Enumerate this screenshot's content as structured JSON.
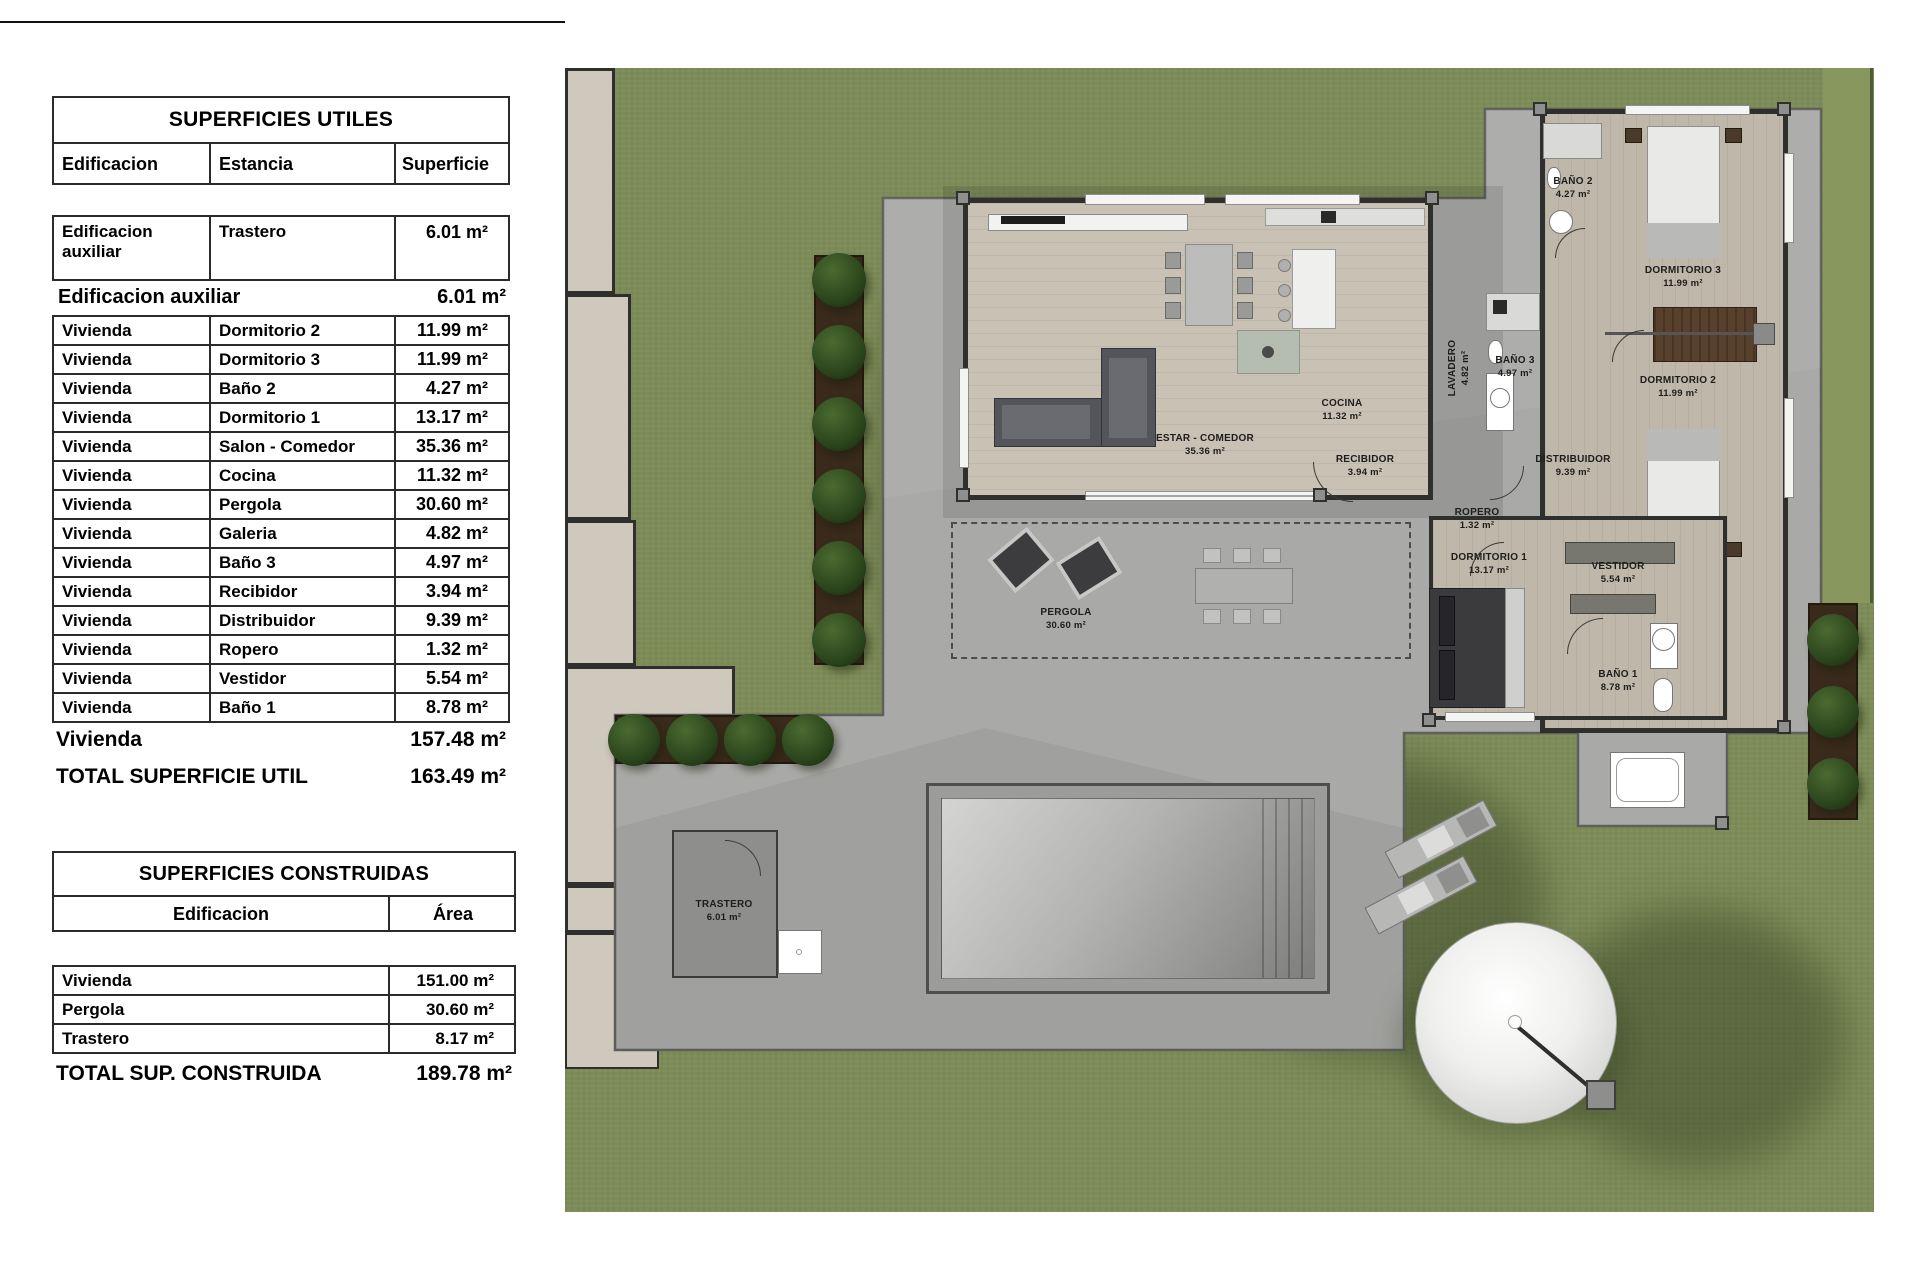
{
  "tables": {
    "utiles": {
      "title": "SUPERFICIES UTILES",
      "columns": {
        "c1": "Edificacion",
        "c2": "Estancia",
        "c3": "Superficie"
      },
      "aux_row": {
        "edificacion": "Edificacion auxiliar",
        "estancia": "Trastero",
        "superficie": "6.01 m²"
      },
      "aux_total": {
        "label": "Edificacion auxiliar",
        "value": "6.01 m²"
      },
      "rows": [
        {
          "edificacion": "Vivienda",
          "estancia": "Dormitorio 2",
          "superficie": "11.99 m²"
        },
        {
          "edificacion": "Vivienda",
          "estancia": "Dormitorio 3",
          "superficie": "11.99 m²"
        },
        {
          "edificacion": "Vivienda",
          "estancia": "Baño 2",
          "superficie": "4.27 m²"
        },
        {
          "edificacion": "Vivienda",
          "estancia": "Dormitorio 1",
          "superficie": "13.17 m²"
        },
        {
          "edificacion": "Vivienda",
          "estancia": "Salon  - Comedor",
          "superficie": "35.36 m²"
        },
        {
          "edificacion": "Vivienda",
          "estancia": "Cocina",
          "superficie": "11.32 m²"
        },
        {
          "edificacion": "Vivienda",
          "estancia": "Pergola",
          "superficie": "30.60 m²"
        },
        {
          "edificacion": "Vivienda",
          "estancia": "Galeria",
          "superficie": "4.82 m²"
        },
        {
          "edificacion": "Vivienda",
          "estancia": "Baño 3",
          "superficie": "4.97 m²"
        },
        {
          "edificacion": "Vivienda",
          "estancia": "Recibidor",
          "superficie": "3.94 m²"
        },
        {
          "edificacion": "Vivienda",
          "estancia": "Distribuidor",
          "superficie": "9.39 m²"
        },
        {
          "edificacion": "Vivienda",
          "estancia": "Ropero",
          "superficie": "1.32 m²"
        },
        {
          "edificacion": "Vivienda",
          "estancia": "Vestidor",
          "superficie": "5.54 m²"
        },
        {
          "edificacion": "Vivienda",
          "estancia": "Baño 1",
          "superficie": "8.78 m²"
        }
      ],
      "vivienda_total": {
        "label": "Vivienda",
        "value": "157.48 m²"
      },
      "grand_total": {
        "label": "TOTAL SUPERFICIE UTIL",
        "value": "163.49 m²"
      }
    },
    "construidas": {
      "title": "SUPERFICIES CONSTRUIDAS",
      "columns": {
        "c1": "Edificacion",
        "c2": "Área"
      },
      "rows": [
        {
          "label": "Vivienda",
          "value": "151.00 m²"
        },
        {
          "label": "Pergola",
          "value": "30.60 m²"
        },
        {
          "label": "Trastero",
          "value": "8.17 m²"
        }
      ],
      "total": {
        "label": "TOTAL SUP. CONSTRUIDA",
        "value": "189.78 m²"
      }
    }
  },
  "plan": {
    "rooms": [
      {
        "name": "ESTAR - COMEDOR",
        "area": "35.36 m²"
      },
      {
        "name": "COCINA",
        "area": "11.32 m²"
      },
      {
        "name": "RECIBIDOR",
        "area": "3.94 m²"
      },
      {
        "name": "DISTRIBUIDOR",
        "area": "9.39 m²"
      },
      {
        "name": "ROPERO",
        "area": "1.32 m²"
      },
      {
        "name": "DORMITORIO 1",
        "area": "13.17 m²"
      },
      {
        "name": "VESTIDOR",
        "area": "5.54 m²"
      },
      {
        "name": "BAÑO 1",
        "area": "8.78 m²"
      },
      {
        "name": "BAÑO 2",
        "area": "4.27 m²"
      },
      {
        "name": "DORMITORIO 3",
        "area": "11.99 m²"
      },
      {
        "name": "DORMITORIO 2",
        "area": "11.99 m²"
      },
      {
        "name": "BAÑO 3",
        "area": "4.97 m²"
      },
      {
        "name": "LAVADERO",
        "area": "4.82 m²"
      },
      {
        "name": "PERGOLA",
        "area": "30.60 m²"
      },
      {
        "name": "TRASTERO",
        "area": "6.01 m²"
      }
    ],
    "colors": {
      "grass": "#7c8b57",
      "hedge": "#87975e",
      "paving": "#a9a9a7",
      "paving_edge": "#5f5f5d",
      "wall": "#2f2f2d",
      "wood": "#c8c1b4",
      "wood_wing": "#beb7aa",
      "bath": "#cfc8bc",
      "planter": "#3a2a1b",
      "tree": "#2f4a21",
      "pool_light": "#d4d4d2",
      "pool_deep": "#7e7e7c",
      "parasol": "#f2f2f0",
      "wardrobe": "#57402c"
    }
  }
}
